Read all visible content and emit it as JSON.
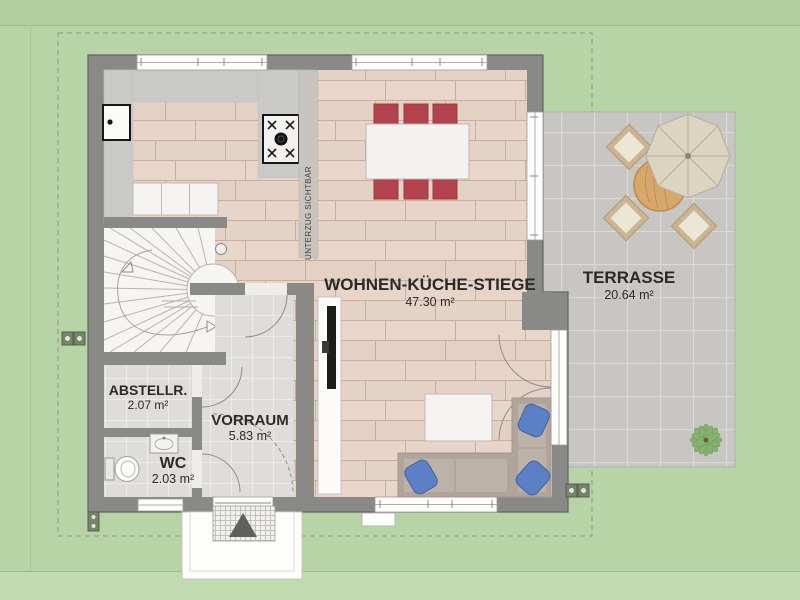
{
  "plan_type": "ground-floor-plan",
  "rooms": {
    "living": {
      "name": "WOHNEN-KÜCHE-STIEGE",
      "area": "47.30 m²"
    },
    "terrace": {
      "name": "TERRASSE",
      "area": "20.64 m²"
    },
    "storage": {
      "name": "ABSTELLR.",
      "area": "2.07 m²"
    },
    "hall": {
      "name": "VORRAUM",
      "area": "5.83 m²"
    },
    "wc": {
      "name": "WC",
      "area": "2.03 m²"
    }
  },
  "annotations": {
    "beam_note": "UNTERZUG SICHTBAR"
  },
  "colors": {
    "garden_green": "#b7d4a6",
    "wall_gray": "#898987",
    "wood_floor": "#e7d4c8",
    "tile_floor": "#dedddb",
    "terrace_gray": "#c7c6c4",
    "dining_chair_red": "#b2434c",
    "sofa_cushion_blue": "#5b80c6",
    "outdoor_wood": "#d8a76c"
  },
  "icons": [
    "kitchen-sink-icon",
    "stove-icon",
    "dining-table-icon",
    "dining-chair-icon",
    "staircase-icon",
    "tv-icon",
    "sideboard-icon",
    "coffee-table-icon",
    "sofa-icon",
    "cushion-icon",
    "toilet-icon",
    "washbasin-icon",
    "outdoor-table-icon",
    "parasol-icon",
    "outdoor-chair-icon",
    "plant-icon",
    "doormat-icon",
    "entrance-arrow-icon",
    "power-socket-icon",
    "downpipe-icon"
  ]
}
